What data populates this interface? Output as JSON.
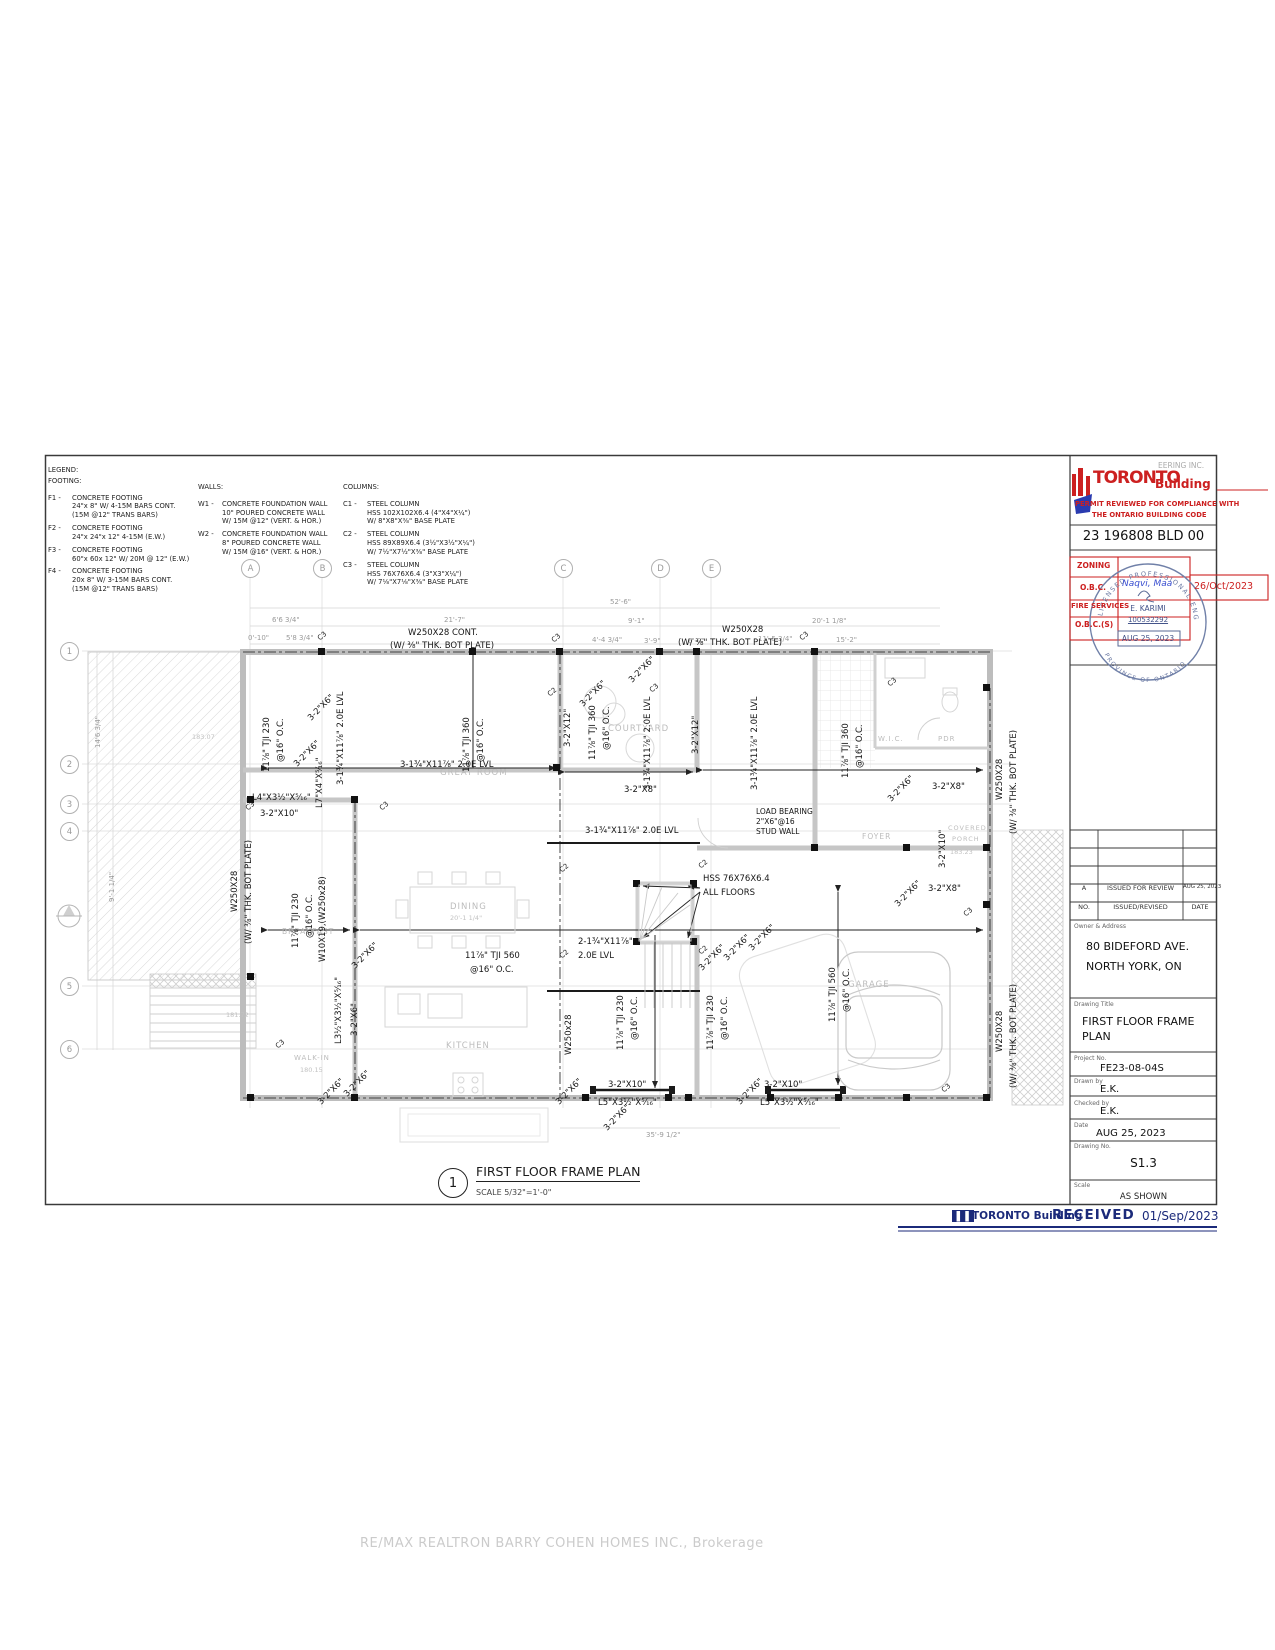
{
  "legend": {
    "title": "LEGEND:",
    "footing_heading": "FOOTING:",
    "walls_heading": "WALLS:",
    "columns_heading": "COLUMNS:",
    "footings": [
      {
        "id": "F1 -",
        "text": "CONCRETE FOOTING\n24\"x 8\" W/ 4-15M BARS CONT.\n(15M @12\" TRANS BARS)"
      },
      {
        "id": "F2 -",
        "text": "CONCRETE FOOTING\n24\"x 24\"x 12\" 4-15M (E.W.)"
      },
      {
        "id": "F3 -",
        "text": "CONCRETE FOOTING\n60\"x 60x 12\" W/ 20M @ 12\" (E.W.)"
      },
      {
        "id": "F4 -",
        "text": "CONCRETE FOOTING\n20x 8\" W/ 3-15M BARS CONT.\n(15M @12\" TRANS BARS)"
      }
    ],
    "walls": [
      {
        "id": "W1 -",
        "text": "CONCRETE FOUNDATION WALL\n10\" POURED CONCRETE WALL\nW/ 15M @12\" (VERT. & HOR.)"
      },
      {
        "id": "W2 -",
        "text": "CONCRETE FOUNDATION WALL\n8\" POURED CONCRETE WALL\nW/ 15M @16\" (VERT. & HOR.)"
      }
    ],
    "columns": [
      {
        "id": "C1 -",
        "text": "STEEL COLUMN\nHSS 102X102X6.4 (4\"X4\"X¼\")\nW/ 8\"X8\"X⅜\" BASE PLATE"
      },
      {
        "id": "C2 -",
        "text": "STEEL COLUMN\nHSS 89X89X6.4 (3½\"X3½\"X¼\")\nW/ 7½\"X7½\"X⅜\" BASE PLATE"
      },
      {
        "id": "C3 -",
        "text": "STEEL COLUMN\nHSS 76X76X6.4 (3\"X3\"X¼\")\nW/ 7⅛\"X7⅛\"X⅜\" BASE PLATE"
      }
    ]
  },
  "stamp": {
    "brand_word1": "TORONTO",
    "brand_word2": "Building",
    "brand_bg": "EERING INC.",
    "review_line1": "PERMIT REVIEWED FOR COMPLIANCE WITH",
    "review_line2": "THE ONTARIO BUILDING CODE",
    "permit_no": "23 196808 BLD 00",
    "row_zoning": "ZONING",
    "row_obc": "O.B.C.",
    "row_fire": "FIRE SERVICES",
    "row_obcs": "O.B.C.(S)",
    "obc_examiner": "Naqvi, Maa",
    "obc_date": "26/Oct/2023",
    "seal_arc_top": "LICENSED PROFESSIONAL ENGINEER",
    "seal_name": "E. KARIMI",
    "seal_license": "100532292",
    "seal_date": "AUG 25, 2023",
    "seal_arc_bottom": "PROVINCE OF ONTARIO"
  },
  "title_block": {
    "rev_no": "A",
    "rev_desc": "ISSUED FOR REVIEW",
    "rev_date": "AUG 25, 2023",
    "rev_h_no": "NO.",
    "rev_h_desc": "ISSUED/REVISED",
    "rev_h_date": "DATE",
    "owner_label": "Owner & Address",
    "owner_line1": "80 BIDEFORD AVE.",
    "owner_line2": "NORTH YORK, ON",
    "title_label": "Drawing Title",
    "title_line1": "FIRST FLOOR FRAME",
    "title_line2": "PLAN",
    "project_label": "Project No.",
    "project_no": "FE23-08-04S",
    "drawn_label": "Drawn by",
    "drawn_by": "E.K.",
    "checked_label": "Checked by",
    "checked_by": "E.K.",
    "date_label": "Date",
    "date": "AUG 25, 2023",
    "dwg_label": "Drawing No.",
    "dwg_no": "S1.3",
    "scale_label": "Scale",
    "scale": "AS SHOWN"
  },
  "received": {
    "brand": "TORONTO Building",
    "word": "RECEIVED",
    "date": "01/Sep/2023"
  },
  "callout": {
    "number": "1",
    "title": "FIRST FLOOR FRAME PLAN",
    "scale": "SCALE 5/32\"=1'-0\""
  },
  "watermark": "RE/MAX REALTRON BARRY COHEN HOMES INC., Brokerage",
  "plan": {
    "grid_cols": [
      "A",
      "B",
      "C",
      "D",
      "E"
    ],
    "grid_rows": [
      "1",
      "2",
      "3",
      "4",
      "5",
      "6"
    ],
    "markers": {
      "c2": "C2",
      "c3": "C3"
    },
    "beams": {
      "w250_cont": "W250X28 CONT.",
      "w250": "W250X28",
      "w250_lc": "W250x28",
      "bot_plate": "(W/ ⅜\" THK. BOT PLATE)",
      "tji230": "11⅞\" TJI 230",
      "tji360": "11⅞\" TJI 360",
      "tji560": "11⅞\" TJI 560",
      "oc16": "@16\" O.C.",
      "lvl3": "3-1¾\"X11⅞\" 2.0E LVL",
      "lvl2a": "2-1¾\"X11⅞\"",
      "lvl2b": "2.0E LVL",
      "w10x19": "W10X19,(W250x28)",
      "hss_a": "HSS 76X76X6.4",
      "hss_b": "ALL FLOORS",
      "lb_a": "LOAD BEARING",
      "lb_b": "2\"X6\"@16",
      "lb_c": "STUD WALL",
      "br2x6": "3-2\"X6\"",
      "br2x8": "3-2\"X8\"",
      "br2x10": "3-2\"X10\"",
      "br2x12": "3-2\"X12\"",
      "l4": "L4\"X3½\"X⁵⁄₁₆\"",
      "l5": "L5\"X3½\"X⁵⁄₁₆\"",
      "l35": "L3½\"X3½\"X⁵⁄₁₆\"",
      "l7": "L7\"X4\"X⁵⁄₁₆\""
    },
    "rooms": {
      "great_room": "GREAT ROOM",
      "courtyard": "COURTYARD",
      "dining": "DINING",
      "dining_dim": "20'-1 1/4\"",
      "breakfast": "BREAKFAST",
      "kitchen": "KITCHEN",
      "foyer": "FOYER",
      "garage": "GARAGE",
      "wic": "W.I.C.",
      "pdr": "PDR",
      "covered": "COVERED",
      "porch": "PORCH",
      "walkin": "WALK-IN"
    },
    "elev": {
      "e1": "183.07",
      "e2": "181.72",
      "e3": "180.15",
      "e4": "183.23"
    },
    "dims": {
      "overall": "52'-6\"",
      "d1": "6'6 3/4\"",
      "d2": "21'-7\"",
      "d3": "9'-1\"",
      "d4": "20'-1 1/8\"",
      "d5": "0'-10\"",
      "d6": "5'8 3/4\"",
      "d7": "4'-4 3/4\"",
      "d8": "3'-9\"",
      "d9": "6'-0\"",
      "d10": "11'-5 3/4\"",
      "d11": "15'-2\"",
      "d12": "35'-9 1/2\"",
      "v1": "14'6 3/4\"",
      "v2": "9'-1 1/4\""
    }
  }
}
